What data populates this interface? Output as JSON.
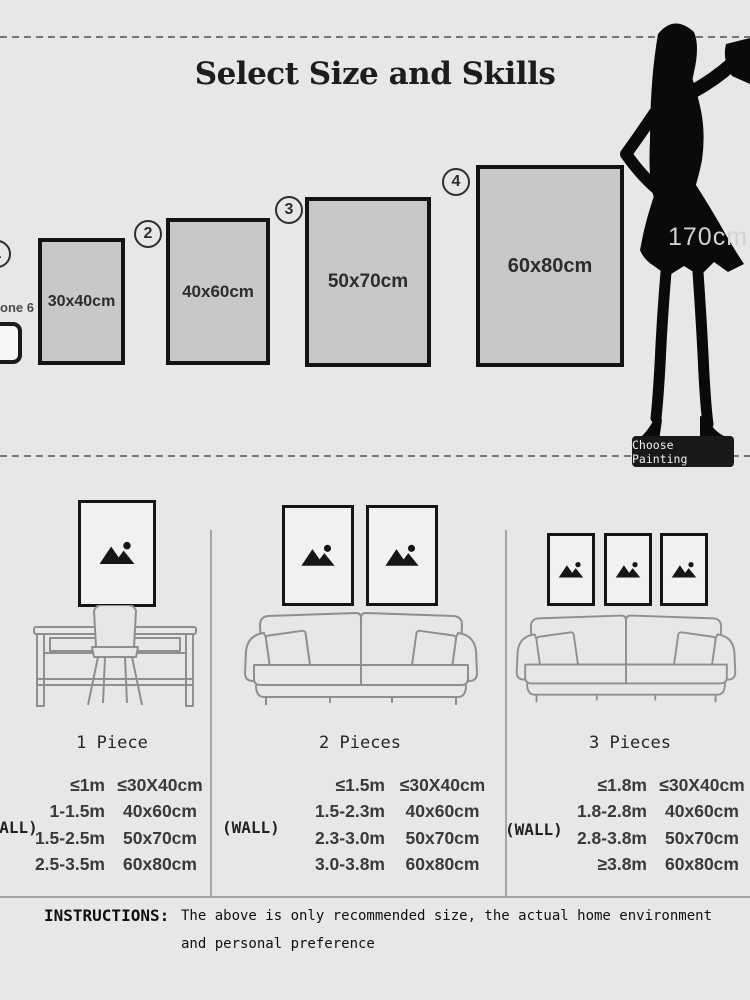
{
  "title": "Select Size and Skills",
  "sizes": [
    {
      "num": "1",
      "label": "30x40cm"
    },
    {
      "num": "2",
      "label": "40x60cm"
    },
    {
      "num": "3",
      "label": "50x70cm"
    },
    {
      "num": "4",
      "label": "60x80cm"
    }
  ],
  "phone": {
    "label": "one 6"
  },
  "model": {
    "height": "170cm",
    "button": "Choose Painting"
  },
  "scenes": [
    {
      "label": "1 Piece"
    },
    {
      "label": "2 Pieces"
    },
    {
      "label": "3 Pieces"
    }
  ],
  "tables": [
    {
      "wall": "(WALL)",
      "rows": [
        [
          "≤1m",
          "≤30X40cm"
        ],
        [
          "1-1.5m",
          "40x60cm"
        ],
        [
          "1.5-2.5m",
          "50x70cm"
        ],
        [
          "2.5-3.5m",
          "60x80cm"
        ]
      ]
    },
    {
      "wall": "(WALL)",
      "rows": [
        [
          "≤1.5m",
          "≤30X40cm"
        ],
        [
          "1.5-2.3m",
          "40x60cm"
        ],
        [
          "2.3-3.0m",
          "50x70cm"
        ],
        [
          "3.0-3.8m",
          "60x80cm"
        ]
      ]
    },
    {
      "wall": "(WALL)",
      "rows": [
        [
          "≤1.8m",
          "≤30X40cm"
        ],
        [
          "1.8-2.8m",
          "40x60cm"
        ],
        [
          "2.8-3.8m",
          "50x70cm"
        ],
        [
          "≥3.8m",
          "60x80cm"
        ]
      ]
    }
  ],
  "instructions": {
    "label": "INSTRUCTIONS:",
    "line1": "The above is only recommended size, the actual home environment",
    "line2": "and personal preference"
  },
  "colors": {
    "background": "#e7e7e7",
    "box_fill": "#c8c8c8",
    "button_dark": "#191919"
  }
}
